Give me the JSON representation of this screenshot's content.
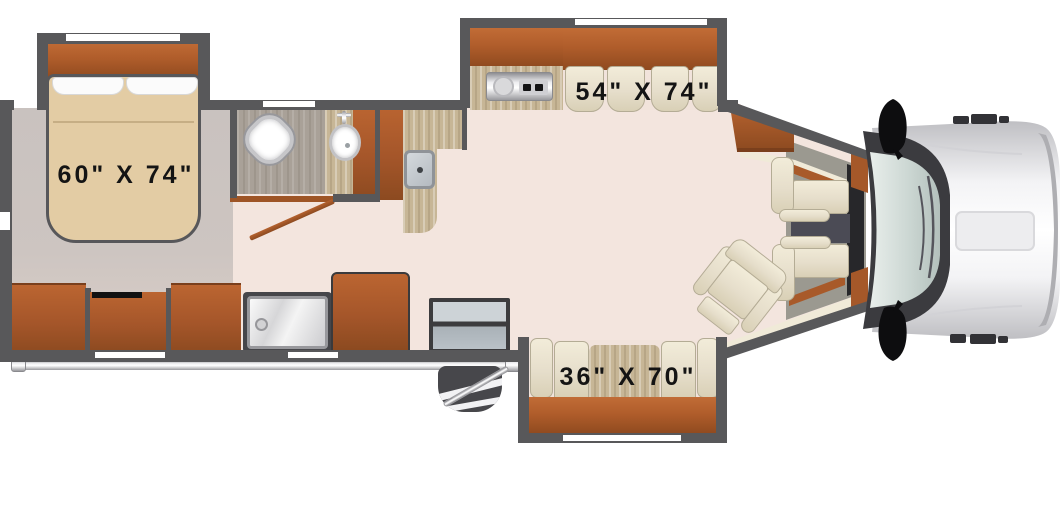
{
  "floorplan": {
    "type": "motorhome-floorplan-top-view",
    "labels": {
      "bed": "60\" X 74\"",
      "dinette_sofa": "54\" X 74\"",
      "sofa": "36\" X 70\""
    },
    "areas": [
      "bedroom",
      "bathroom",
      "kitchen",
      "living-area",
      "cab"
    ],
    "furniture": [
      "queen-bed",
      "dresser",
      "tv-cabinet",
      "shower",
      "toilet",
      "bathroom-sink",
      "wardrobe",
      "kitchen-sink",
      "cooktop",
      "refrigerator",
      "dinette-sofa",
      "sofa",
      "recliner",
      "entry-steps",
      "passenger-seat",
      "driver-seat",
      "truck-cab-front"
    ],
    "palette": {
      "wall": "#58585a",
      "wood": "#b05d2b",
      "floor_main": "#f3e5de",
      "floor_bedroom": "#cbc4c0",
      "floor_bathroom": "#a9a198",
      "counter": "#c7b696",
      "mattress": "#e3cca4",
      "cushion": "#ece5d1",
      "cab_trim": "#9b9990",
      "carpet": "#4b4b55",
      "glass": "#c2cfcb",
      "vehicle_body": "#f2f2f4",
      "label_text": "#141414"
    }
  }
}
